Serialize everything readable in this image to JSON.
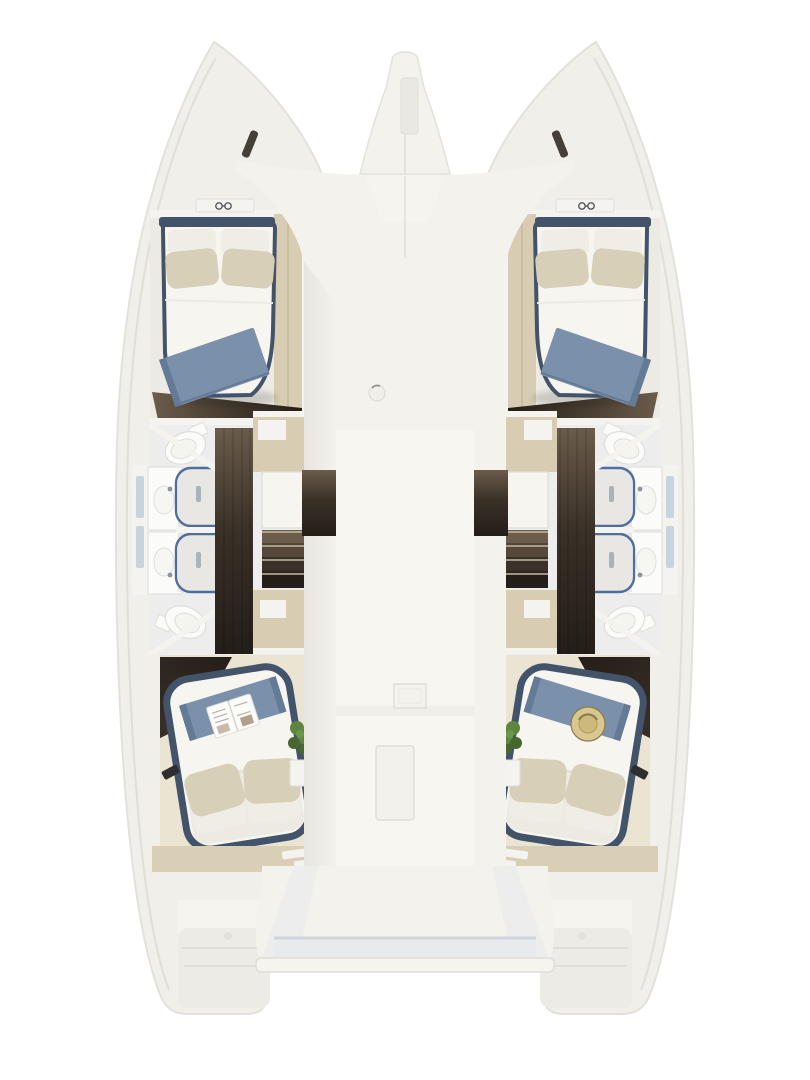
{
  "scene": {
    "label": "Catamaran four-cabin interior floor plan, top view",
    "port_forward_cabin": "Forward double berth with navy trim, beige pillows and blue throw",
    "starboard_forward_cabin": "Forward double berth with navy trim, beige pillows and blue throw",
    "port_bathrooms": "Two bathrooms with toilets, twin showers and vanities",
    "starboard_bathrooms": "Two bathrooms with toilets, twin showers and vanities",
    "port_aft_cabin": "Aft island bed with blue runner and open magazine",
    "starboard_aft_cabin": "Aft island bed with blue runner and straw hat",
    "center_deck": "White nacelle deck with hatches",
    "stern": "Aft platform between transoms"
  },
  "palette": {
    "bg": "#ffffff",
    "hull": "#f1efe9",
    "hullEdge": "#e3e1db",
    "deckLight": "#f6f4ef",
    "deckShade": "#e7e5df",
    "nacelle": "#f4f2ec",
    "nacelleInner": "#f8f6f1",
    "wallWhite": "#f4f3ef",
    "roomFloor": "#ecedec",
    "cabinetBeige": "#d8cdb2",
    "cabinetBeigeDark": "#c6b99d",
    "deckBeige": "#d9cfb6",
    "wood1": "#6b5c4b",
    "wood2": "#3a3128",
    "wood3": "#241e18",
    "bedWhite": "#f7f5f0",
    "bedShadow": "#eceae2",
    "pillowBeige": "#d8cfb8",
    "pillowWhite": "#f0ede4",
    "navy": "#42536a",
    "navyDark": "#37475c",
    "throwBlue": "#7b90aa",
    "throwBlueDark": "#647b97",
    "showerBlue": "#4e6f9d",
    "showerFloor": "#e8e7e3",
    "fixtureWhite": "#fbfbf9",
    "fixtureEdge": "#dededa",
    "windowBlue": "#c7d3df",
    "plantGreen": "#5d8540",
    "plantGreenDark": "#47672f",
    "hatStraw": "#d9c78f",
    "hatBand": "#8a7a4e",
    "platformShade": "#e8eaee",
    "platformShadow": "#c9cfda",
    "itemDark": "#2e2e30",
    "lineSoft": "#e0ded8"
  }
}
